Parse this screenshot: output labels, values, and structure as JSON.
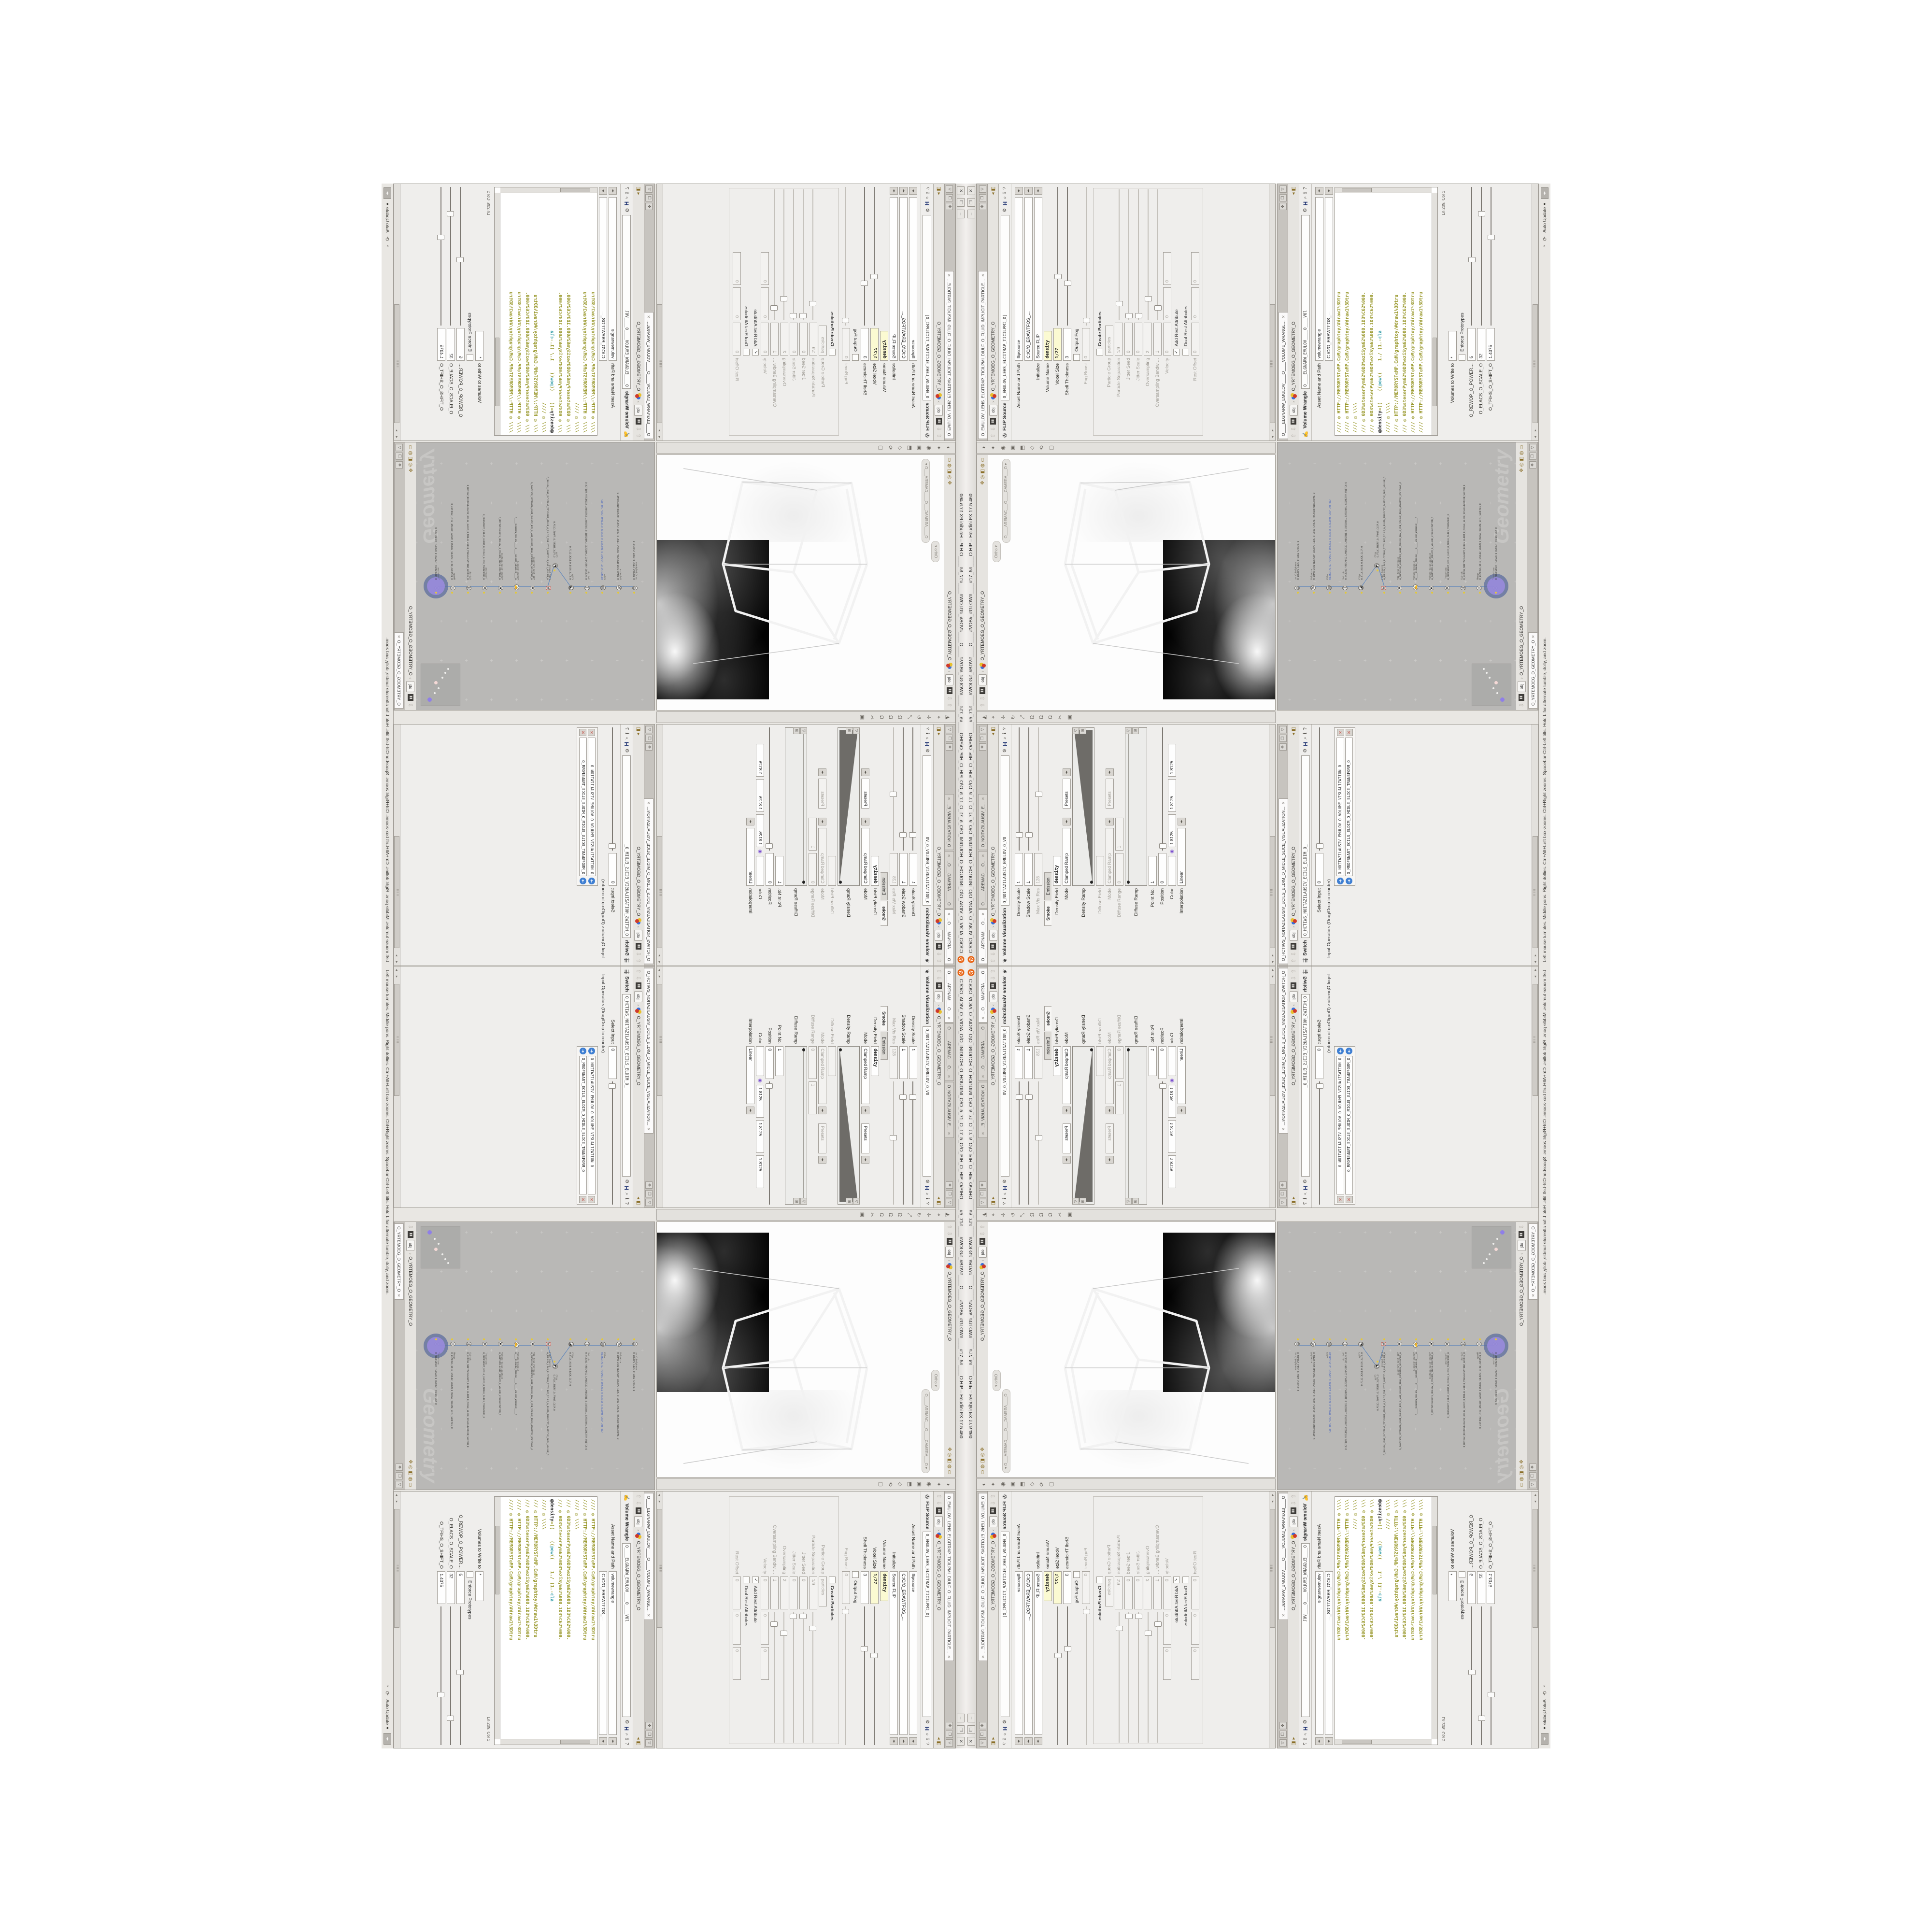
{
  "window": {
    "title": "C:/O/O_AIDIV_O_VIDIA_O/O_INIDUOH_O_HOUDINI_O/O_5_71_O_17_5_O/O_PIH_O_HIP_O/PIHO____#5_71#____#WOLG#_#BDV#____O____#VDB#_#GLOW#____#17_5#____O.HIP – Houdini FX 17.5.460",
    "buttons": {
      "minimize": "–",
      "maximize": "❐",
      "close": "✕"
    }
  },
  "colors": {
    "accent_orange": "#e8610f",
    "select_purple": "#9c8ce0",
    "wire_blue": "#6b8cba",
    "expr_yellow": "#fbfad2",
    "code_olive": "#9a992e",
    "code_teal": "#2e9aa6",
    "network_bg": "#b9b8b6"
  },
  "breadcrumb": {
    "root": "obj",
    "sep": "›",
    "path": "O_YRTEMOEG_O_GEOMETRY_O"
  },
  "icons": {
    "close": "✕",
    "pin": "✥",
    "maximize_pane": "❒",
    "pane_menu": "▽",
    "gear": "⚙",
    "houdini_badge": "H",
    "search": "⌕",
    "info": "ℹ",
    "help": "?",
    "nav_up": "⇧",
    "nav_down": "⇩",
    "menu_pair": "◂▸",
    "scroll_left": "◂",
    "scroll_right": "▸",
    "recook": "⟳",
    "dropdown": "▾",
    "viewport_left_toolbar": [
      "◭",
      "⌖",
      "✛",
      "↻",
      "⤢",
      "Ω",
      "Ω",
      "Ω",
      "✂",
      "▣"
    ],
    "viewport_right_toolbar": [
      "◑",
      "✦",
      "◉",
      "▣",
      "⬒",
      "◇",
      "⟲",
      "▢"
    ],
    "pathbar_right_icons": [
      "✥",
      "◎",
      "◧",
      "◍",
      "▭"
    ]
  },
  "panes": {
    "vol_vis": {
      "tabs": [
        {
          "label": "O____ARTNAM___O…",
          "active": true
        },
        {
          "label": "O_____AREMAC___O…",
          "active": false
        },
        {
          "label": "O_NOITAZILAUSIV_E…",
          "active": false
        }
      ],
      "node_type": "Volume Visualization",
      "node_icon": "❦",
      "node_path": "O_NOITAZILAUSIV_EMULOV_O_VO",
      "rows": [
        {
          "t": "slider",
          "l": "Density Scale",
          "v": "1",
          "pos": 0.12
        },
        {
          "t": "slider",
          "l": "Shadow Scale",
          "v": "1",
          "pos": 0.12
        },
        {
          "t": "slider",
          "l": "Max Vis Res",
          "v": "128",
          "pos": 0.45,
          "dim": true
        },
        {
          "t": "ftabs",
          "tabs": [
            "Smoke",
            "Emission"
          ],
          "active": 0
        },
        {
          "t": "field",
          "l": "Density Field",
          "v": "density",
          "bold": true
        },
        {
          "t": "menu",
          "l": "Mode",
          "v": "Clamped Ramp",
          "extra": "Presets"
        },
        {
          "t": "ramp",
          "l": "Density Ramp",
          "wedge": true
        },
        {
          "t": "field",
          "l": "Diffuse Field",
          "v": "",
          "dim": true
        },
        {
          "t": "menu",
          "l": "Mode",
          "v": "Clamped Ramp",
          "extra": "Presets",
          "dim": true
        },
        {
          "t": "range2",
          "l": "Diffuse Range",
          "v": [
            "0",
            "1"
          ],
          "dim": true
        },
        {
          "t": "ramp",
          "l": "Diffuse Ramp",
          "wedge": false
        },
        {
          "t": "field",
          "l": "Point No.",
          "v": "1"
        },
        {
          "t": "slider",
          "l": "Position",
          "v": "0",
          "pos": 0.03
        },
        {
          "t": "color",
          "l": "Color",
          "v": [
            "1.8125",
            "1.8125",
            "1.8125"
          ]
        },
        {
          "t": "menu",
          "l": "Interpolation",
          "v": "Linear"
        }
      ]
    },
    "switch": {
      "tabs": [
        {
          "label": "O_HCTIWS_NOITAZILAUSIV_ECILS_ELDIM_O_MIDLE_SLICE_VISUALIZATION…",
          "active": true
        }
      ],
      "node_type": "Switch",
      "node_icon": "⇶",
      "node_path": "O_HCTIWS_NOITAZILAUSIV_ECILS_ELDIM_O_",
      "rows": [
        {
          "t": "slider",
          "l": "Select Input",
          "v": "0",
          "pos": 0.03
        },
        {
          "t": "label",
          "l": "Input Operators (Drag/Drop to reorder)"
        },
        {
          "t": "oplist",
          "items": [
            "O_NOITAZILAUSIV_EMULOV_O_VOLUME_VISUALIZATION_O",
            "O_MROFSNART_ECILS_ELDIM_O_MIDLE_SLICE_TRANSFORM_O"
          ]
        }
      ]
    },
    "flip": {
      "tabs": [
        {
          "label": "O_EMULOV_LEHS_ELCITRAP_TICILPMI_DIULF_O_FLUID_IMPLICIT_PARTICLE…",
          "active": true
        }
      ],
      "node_type": "FLIP Source",
      "node_icon": "✇",
      "node_path": "O_EMULOV_LEHS_ELCITRAP_TICILPMI_D]",
      "rows": [
        {
          "t": "menufield",
          "l": "Asset Name and Path",
          "v": "flipsource"
        },
        {
          "t": "menufield",
          "l": "",
          "v": "C:/O/O_ERAWTFOS_…"
        },
        {
          "t": "menufield",
          "l": "Initialize",
          "v": "Source FLIP"
        },
        {
          "t": "field",
          "l": "Volume Name",
          "v": "density",
          "bold": true,
          "yellow": true
        },
        {
          "t": "slider",
          "l": "Voxel Size",
          "v": "1/27",
          "pos": 0.35,
          "yellow": true,
          "bold": true
        },
        {
          "t": "slider",
          "l": "Shell Thickness",
          "v": "3",
          "pos": 0.3
        },
        {
          "t": "check",
          "l": "",
          "cl": "Output Fog",
          "checked": false
        },
        {
          "t": "slider",
          "l": "Fog Boost",
          "v": "0",
          "pos": 0.03,
          "dim": true
        },
        {
          "t": "group",
          "l": "Particles"
        },
        {
          "t": "check",
          "l": "",
          "cl": "Create Particles",
          "bold": true,
          "checked": false
        },
        {
          "t": "field",
          "l": "Particle Group",
          "v": "particles",
          "dim": true
        },
        {
          "t": "slider",
          "l": "Particle Separation",
          "v": "1/9",
          "pos": 0.12,
          "dim": true
        },
        {
          "t": "slider",
          "l": "Jitter Seed",
          "v": "0",
          "pos": 0.03,
          "dim": true
        },
        {
          "t": "slider",
          "l": "Jitter Scale",
          "v": "0",
          "pos": 0.03,
          "dim": true
        },
        {
          "t": "slider",
          "l": "Oversampling",
          "v": "2",
          "pos": 0.16,
          "dim": true
        },
        {
          "t": "slider",
          "l": "Oversampling Bandwi…",
          "v": "1",
          "pos": 0.09,
          "dim": true
        },
        {
          "t": "triple",
          "l": "Velocity",
          "v": [
            "0",
            "0",
            "0"
          ],
          "dim": true
        },
        {
          "t": "check",
          "l": "",
          "cl": "Add Rest Attribute",
          "checked": true
        },
        {
          "t": "check",
          "l": "",
          "cl": "Dual Rest Attributes",
          "checked": false
        },
        {
          "t": "triple",
          "l": "Rest Offset",
          "v": [
            "0",
            "0",
            "0"
          ],
          "dim": true
        }
      ]
    },
    "wrangle": {
      "tabs": [
        {
          "label": "O____ELGNARW_EMULOV____O____VOLUME_WRANGL…",
          "active": true
        }
      ],
      "node_type": "Volume Wrangle",
      "node_icon": "✍",
      "node_path": "O____ELGNARW_EMULOV____O____VOl",
      "rows_top": [
        {
          "t": "menufield",
          "l": "Asset Name and Path",
          "v": "volumewrangle"
        },
        {
          "t": "menufield",
          "l": "",
          "v": "C:/O/O_ERAWTFOS_…"
        }
      ],
      "code": [
        "//// ◎ HTTP://MEMORYST◎MP.C◎M/graphtoy/#draw1%3Dtru",
        "//// ◎ HTTP://MEMORYST◎MP.C◎M/graphtoy/#draw1%3Dtru",
        "//// ◎ \\\\\\\\",
        "/// ◎ 0D3%steserPym62%0D3%eziSym62%000.1D3%C62%000.",
        "/// ◎ 0D3%steserPym62%0D3%eziSym62%000.1D3%C62%000.",
        "@density=((    ((pow((    1./ (1.-cla",
        "//// ◎ \\\\\\\\",
        "/// ◎ HTTP://MEMORYST◎MP.C◎M/graphtoy/#draw1%3Dtru",
        "/// ◎ 0D3%steserPym62%0D3%eziSym62%000.1D3%C62%000.",
        "//// ◎ HTTP://MEMORYST◎MP.C◎M/graphtoy/#draw1%3Dtru",
        "//// ◎ HTTP://MEMORYST◎MP.C◎M/graphtoy/#draw1%3Dtru"
      ],
      "lncol": "Ln 209, Col 1",
      "rows_bottom": [
        {
          "t": "field",
          "l": "Volumes to Write to",
          "v": "*"
        },
        {
          "t": "check",
          "l": "",
          "cl": "Enforce Prototypes",
          "checked": false
        },
        {
          "t": "slider",
          "l": "O_REWOP_O_POWER…",
          "v": "6",
          "pos": 0.47
        },
        {
          "t": "slider",
          "l": "O_ELACS_O_SCALE_O",
          "v": "32",
          "pos": 0.8
        },
        {
          "t": "slider",
          "l": "O_TFIHS_O_SHIFT_O",
          "v": "1.4375",
          "pos": 0.63
        }
      ]
    },
    "viewport": {
      "view_pill": "Ortho",
      "cam_pill": "O____AREMAC___O____CAMERA___O"
    },
    "network": {
      "tabs": [
        {
          "label": "O_YRTEMOEG_O_GEOMETRY_O",
          "active": true
        }
      ],
      "watermark": "Geometry",
      "nodes": [
        {
          "type": "an CubeSphere",
          "name": "O_EREHPS_EBUC_O_CUBE_SPHERE_O",
          "glyph": "◍"
        },
        {
          "type": "PolyWire",
          "name": "O_EMARFERIW_NOGYLOP_EREHPS_EBUC_O_CUBE_SPHERE_POLYGON_WIREFRAME_O",
          "glyph": "⌘"
        },
        {
          "type": "File",
          "name": "8O.M03.PETS.TRI6ALS_O_55U.REG_O_GEN455_O.SLOPRT STEP 304.OBJ",
          "glyph": "▤",
          "blue": true
        },
        {
          "type": "Switch",
          "name": "O_HCTIWS_YRTEMOEG_LANRETXE_LANRETNI_O_INTERNAL_EXTERNAL_GEOMETRY_SWITCH_O",
          "glyph": "⇶"
        },
        {
          "type": "Clip",
          "name": "O_PILC_KCAB_O_BACK_CLIP_O",
          "glyph": "◪"
        },
        {
          "type": "Clip",
          "name": "O_PILC_TNORF_O_FRONT_CLIP_O",
          "glyph": "◩",
          "side": true
        },
        {
          "type": "FLIP Source",
          "name": "O_EMULOV_LEHS_ELCITRAP_TICILPMI_DIULF_O_FLUID_IMPLICIT_PARTICLE_SHEL_VOLUME_O",
          "glyph": "✇",
          "red": true
        },
        {
          "type": "VDB from Polygons",
          "name": "O_SNOGYLOP_YRTEMOEG_MORF_EMULOV_BDV_O_VDB_VOLUME_FROM_GEOMETRY_POLYGONS_O",
          "glyph": "❖"
        },
        {
          "type": "Volume Wrangle",
          "name": "O____ELGNARW_EMULOV____O____VOLUME_WRANGLE____O",
          "glyph": "✍"
        },
        {
          "type": "Volume Visualization",
          "name": "O_NOITAZILAUSIV_EMULOV_O_VOLUME_VISUALIZATION_O",
          "glyph": "❦"
        },
        {
          "type": "Transform",
          "name": "O_MROFSNART_ECILS_ELDIM_O_MIDLE_SLICE_TRANSFORM_O",
          "glyph": "✥"
        },
        {
          "type": "Switch",
          "name": "O_HCTIWS_NOITAZILAUSIV_ECILS_ELDIM_O_MIDLE_SLICE_VISUALIZATION_SWITCH_O",
          "glyph": "⇶"
        },
        {
          "type": "Merge",
          "name": "O_ECAFRUS_HTIW_EMULOV_EGREM_O_MERGE_VOLUME_WITH_SURFACE_O",
          "glyph": "⊕"
        },
        {
          "type": "Transform",
          "name": "O_MROFSNART_TLUSER_O_RESULT_TRANSFORM_O",
          "glyph": "✥",
          "selected": true
        }
      ]
    }
  },
  "statusbar": {
    "help": "Left mouse tumbles. Middle pans. Right dollies. Ctrl+Alt+Left box-zooms. Ctrl+Right zooms. Spacebar-Ctrl-Left tilts. Hold L for alternate tumble, dolly, and zoom.",
    "update_mode": "Auto Update"
  }
}
